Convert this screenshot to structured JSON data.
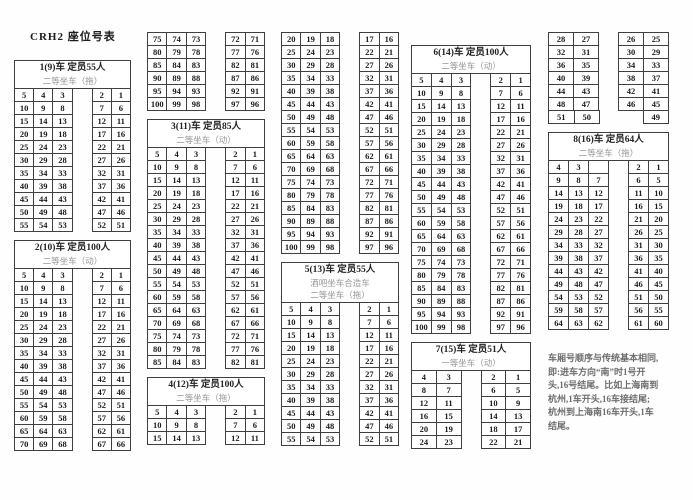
{
  "title": "CRH2 座位号表",
  "columns": [
    {
      "blocks": [
        {
          "type": "seats",
          "header": [
            "1(9)车 定员55人",
            "二等坐车（拖）"
          ],
          "left": 3,
          "rows": [
            [
              5,
              4,
              3,
              2,
              1
            ],
            [
              10,
              9,
              8,
              7,
              6
            ],
            [
              15,
              14,
              13,
              12,
              11
            ],
            [
              20,
              19,
              18,
              17,
              16
            ],
            [
              25,
              24,
              23,
              22,
              21
            ],
            [
              30,
              29,
              28,
              27,
              26
            ],
            [
              35,
              34,
              33,
              32,
              31
            ],
            [
              40,
              39,
              38,
              37,
              36
            ],
            [
              45,
              44,
              43,
              42,
              41
            ],
            [
              50,
              49,
              48,
              47,
              46
            ],
            [
              55,
              54,
              53,
              52,
              51
            ]
          ]
        },
        {
          "type": "seats",
          "header": [
            "2(10)车 定员100人",
            "二等坐车（动）"
          ],
          "left": 3,
          "rows": [
            [
              5,
              4,
              3,
              2,
              1
            ],
            [
              10,
              9,
              8,
              7,
              6
            ],
            [
              15,
              14,
              13,
              12,
              11
            ],
            [
              20,
              19,
              18,
              17,
              16
            ],
            [
              25,
              24,
              23,
              22,
              21
            ],
            [
              30,
              29,
              28,
              27,
              26
            ],
            [
              35,
              34,
              33,
              32,
              31
            ],
            [
              40,
              39,
              38,
              37,
              36
            ],
            [
              45,
              44,
              43,
              42,
              41
            ],
            [
              50,
              49,
              48,
              47,
              46
            ],
            [
              55,
              54,
              53,
              52,
              51
            ],
            [
              60,
              59,
              58,
              57,
              56
            ],
            [
              65,
              64,
              63,
              62,
              61
            ],
            [
              70,
              69,
              68,
              67,
              66
            ]
          ]
        }
      ]
    },
    {
      "blocks": [
        {
          "type": "seats",
          "left": 3,
          "rows": [
            [
              75,
              74,
              73,
              72,
              71
            ],
            [
              80,
              79,
              78,
              77,
              76
            ],
            [
              85,
              84,
              83,
              82,
              81
            ],
            [
              90,
              89,
              88,
              87,
              86
            ],
            [
              95,
              94,
              93,
              92,
              91
            ],
            [
              100,
              99,
              98,
              97,
              96
            ]
          ]
        },
        {
          "type": "seats",
          "header": [
            "3(11)车 定员85人",
            "二等坐车（动）"
          ],
          "left": 3,
          "rows": [
            [
              5,
              4,
              3,
              2,
              1
            ],
            [
              10,
              9,
              8,
              7,
              6
            ],
            [
              15,
              14,
              13,
              12,
              11
            ],
            [
              20,
              19,
              18,
              17,
              16
            ],
            [
              25,
              24,
              23,
              22,
              21
            ],
            [
              30,
              29,
              28,
              27,
              26
            ],
            [
              35,
              34,
              33,
              32,
              31
            ],
            [
              40,
              39,
              38,
              37,
              36
            ],
            [
              45,
              44,
              43,
              42,
              41
            ],
            [
              50,
              49,
              48,
              47,
              46
            ],
            [
              55,
              54,
              53,
              52,
              51
            ],
            [
              60,
              59,
              58,
              57,
              56
            ],
            [
              65,
              64,
              63,
              62,
              61
            ],
            [
              70,
              69,
              68,
              67,
              66
            ],
            [
              75,
              74,
              73,
              72,
              71
            ],
            [
              80,
              79,
              78,
              77,
              76
            ],
            [
              85,
              84,
              83,
              82,
              81
            ]
          ]
        },
        {
          "type": "seats",
          "header": [
            "4(12)车 定员100人",
            "二等坐车（拖）"
          ],
          "left": 3,
          "rows": [
            [
              5,
              4,
              3,
              2,
              1
            ],
            [
              10,
              9,
              8,
              7,
              6
            ],
            [
              15,
              14,
              13,
              12,
              11
            ]
          ]
        }
      ]
    },
    {
      "blocks": [
        {
          "type": "seats",
          "left": 3,
          "rows": [
            [
              20,
              19,
              18,
              17,
              16
            ],
            [
              25,
              24,
              23,
              22,
              21
            ],
            [
              30,
              29,
              28,
              27,
              26
            ],
            [
              35,
              34,
              33,
              32,
              31
            ],
            [
              40,
              39,
              38,
              37,
              36
            ],
            [
              45,
              44,
              43,
              42,
              41
            ],
            [
              50,
              49,
              48,
              47,
              46
            ],
            [
              55,
              54,
              53,
              52,
              51
            ],
            [
              60,
              59,
              58,
              57,
              56
            ],
            [
              65,
              64,
              63,
              62,
              61
            ],
            [
              70,
              69,
              68,
              67,
              66
            ],
            [
              75,
              74,
              73,
              72,
              71
            ],
            [
              80,
              79,
              78,
              77,
              76
            ],
            [
              85,
              84,
              83,
              82,
              81
            ],
            [
              90,
              89,
              88,
              87,
              86
            ],
            [
              95,
              94,
              93,
              92,
              91
            ],
            [
              100,
              99,
              98,
              97,
              96
            ]
          ]
        },
        {
          "type": "seats",
          "header": [
            "5(13)车 定员55人",
            "酒吧坐车合造车",
            "二等坐车（拖）"
          ],
          "left": 3,
          "rows": [
            [
              5,
              4,
              3,
              2,
              1
            ],
            [
              10,
              9,
              8,
              7,
              6
            ],
            [
              15,
              14,
              13,
              12,
              11
            ],
            [
              20,
              19,
              18,
              17,
              16
            ],
            [
              25,
              24,
              23,
              22,
              21
            ],
            [
              30,
              29,
              28,
              27,
              26
            ],
            [
              35,
              34,
              33,
              32,
              31
            ],
            [
              40,
              39,
              38,
              37,
              36
            ],
            [
              45,
              44,
              43,
              42,
              41
            ],
            [
              50,
              49,
              48,
              47,
              46
            ],
            [
              55,
              54,
              53,
              52,
              51
            ]
          ]
        }
      ]
    },
    {
      "blocks": [
        {
          "type": "seats",
          "header": [
            "6(14)车 定员100人",
            "二等坐车（动）"
          ],
          "left": 3,
          "rows": [
            [
              5,
              4,
              3,
              2,
              1
            ],
            [
              10,
              9,
              8,
              7,
              6
            ],
            [
              15,
              14,
              13,
              12,
              11
            ],
            [
              20,
              19,
              18,
              17,
              16
            ],
            [
              25,
              24,
              23,
              22,
              21
            ],
            [
              30,
              29,
              28,
              27,
              26
            ],
            [
              35,
              34,
              33,
              32,
              31
            ],
            [
              40,
              39,
              38,
              37,
              36
            ],
            [
              45,
              44,
              43,
              42,
              41
            ],
            [
              50,
              49,
              48,
              47,
              46
            ],
            [
              55,
              54,
              53,
              52,
              51
            ],
            [
              60,
              59,
              58,
              57,
              56
            ],
            [
              65,
              64,
              63,
              62,
              61
            ],
            [
              70,
              69,
              68,
              67,
              66
            ],
            [
              75,
              74,
              73,
              72,
              71
            ],
            [
              80,
              79,
              78,
              77,
              76
            ],
            [
              85,
              84,
              83,
              82,
              81
            ],
            [
              90,
              89,
              88,
              87,
              86
            ],
            [
              95,
              94,
              93,
              92,
              91
            ],
            [
              100,
              99,
              98,
              97,
              96
            ]
          ]
        },
        {
          "type": "seats",
          "header": [
            "7(15)车 定员51人",
            "一等坐车（动）"
          ],
          "left": 2,
          "rows": [
            [
              4,
              3,
              2,
              1
            ],
            [
              8,
              7,
              6,
              5
            ],
            [
              12,
              11,
              10,
              9
            ],
            [
              16,
              15,
              14,
              13
            ],
            [
              20,
              19,
              18,
              17
            ],
            [
              24,
              23,
              22,
              21
            ]
          ]
        }
      ]
    },
    {
      "blocks": [
        {
          "type": "seats",
          "left": 2,
          "rows": [
            [
              28,
              27,
              26,
              25
            ],
            [
              32,
              31,
              30,
              29
            ],
            [
              36,
              35,
              34,
              33
            ],
            [
              40,
              39,
              38,
              37
            ],
            [
              44,
              43,
              42,
              41
            ],
            [
              48,
              47,
              46,
              45
            ],
            [
              51,
              50,
              null,
              49
            ]
          ]
        },
        {
          "type": "seats",
          "header": [
            "8(16)车 定员64人",
            "二等坐车（拖）"
          ],
          "left": 3,
          "rows": [
            [
              4,
              3,
              "",
              2,
              1
            ],
            [
              9,
              8,
              7,
              6,
              5
            ],
            [
              14,
              13,
              12,
              11,
              10
            ],
            [
              19,
              18,
              17,
              16,
              15
            ],
            [
              24,
              23,
              22,
              21,
              20
            ],
            [
              29,
              28,
              27,
              26,
              25
            ],
            [
              34,
              33,
              32,
              31,
              30
            ],
            [
              39,
              38,
              37,
              36,
              35
            ],
            [
              44,
              43,
              42,
              41,
              40
            ],
            [
              49,
              48,
              47,
              46,
              45
            ],
            [
              54,
              53,
              52,
              51,
              50
            ],
            [
              59,
              58,
              57,
              56,
              55
            ],
            [
              64,
              63,
              62,
              61,
              60
            ]
          ]
        },
        {
          "type": "note",
          "lines": [
            "车厢号顺序与传统基本相同,",
            "即:进车方向“南”时1号开",
            "头,16号结尾。比如上海南到",
            "杭州,1车开头,16车接结尾;",
            "杭州到上海南16车开头,1车",
            "结尾。"
          ]
        }
      ]
    }
  ]
}
